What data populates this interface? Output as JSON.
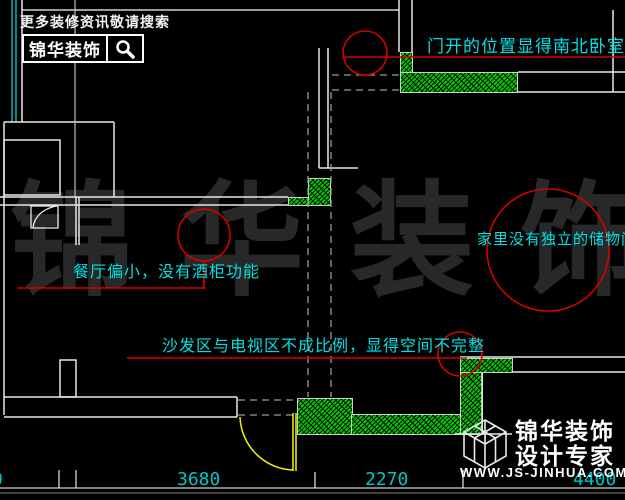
{
  "page": {
    "width": 625,
    "height": 500,
    "bg": "#000000"
  },
  "colors": {
    "annotation_cyan": "#00e2e2",
    "dimension_cyan": "#00c6c6",
    "redline": "#d40000",
    "wall_green": "#00cc00",
    "door_yellow": "#f2f20a",
    "cad_white": "#e8e8e8",
    "watermark_gray": "#282828"
  },
  "header_logo": {
    "tagline": "更多装修资讯敬请搜索",
    "brand": "锦华装饰"
  },
  "annotations": {
    "door_note": "门开的位置显得南北卧室通风",
    "storage_note": "家里没有独立的储物间",
    "dining_note": "餐厅偏小，没有酒柜功能",
    "sofa_note": "沙发区与电视区不成比例，显得空间不完整"
  },
  "dimensions": {
    "clipped_left": "0",
    "dim_3680": "3680",
    "dim_2270": "2270",
    "dim_4400": "4400"
  },
  "watermark": {
    "chars": [
      "锦",
      "华",
      "装",
      "饰"
    ]
  },
  "footer_logo": {
    "brand": "锦华装饰",
    "subtitle": "设计专家",
    "website": "WWW.JS-JINHUA.COM"
  },
  "icons": {
    "search": "magnifier-icon",
    "cube": "cube-logo-icon"
  }
}
